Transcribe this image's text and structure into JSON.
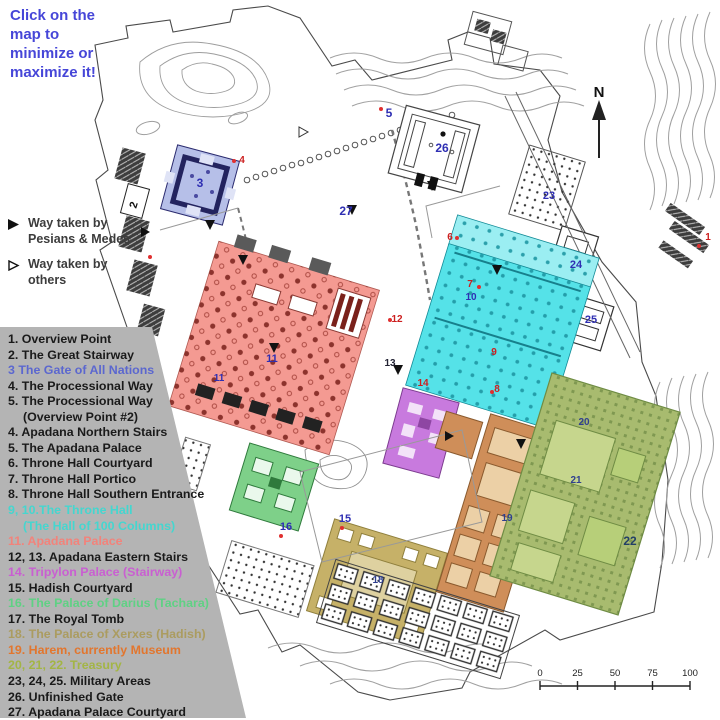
{
  "instruction": {
    "line1": "Click on the",
    "line2": "map to",
    "line3": "minimize or",
    "line4": "maximize it!"
  },
  "way_legend": [
    {
      "marker": "filled-arrow",
      "line1": "Way taken by",
      "line2": "Pesians & Medes"
    },
    {
      "marker": "open-arrow",
      "line1": "Way taken by",
      "line2": "others"
    }
  ],
  "legend": {
    "items": [
      {
        "text": "1. Overview Point",
        "color": "#1a1a1a"
      },
      {
        "text": "2. The Great Stairway",
        "color": "#1a1a1a"
      },
      {
        "text": "3 The Gate of All Nations",
        "color": "#5b67cf"
      },
      {
        "text": "4. The Processional Way",
        "color": "#1a1a1a"
      },
      {
        "text": "5. The Processional Way",
        "color": "#1a1a1a"
      },
      {
        "text": "(Overview Point #2)",
        "color": "#1a1a1a",
        "indent": true
      },
      {
        "text": "4. Apadana Northern Stairs",
        "color": "#1a1a1a"
      },
      {
        "text": "5. The Apadana Palace",
        "color": "#1a1a1a"
      },
      {
        "text": "6. Throne Hall Courtyard",
        "color": "#1a1a1a"
      },
      {
        "text": "7. Throne Hall Portico",
        "color": "#1a1a1a"
      },
      {
        "text": "8. Throne Hall Southern Entrance",
        "color": "#1a1a1a"
      },
      {
        "text": "9, 10.The Throne Hall",
        "color": "#45d6cf"
      },
      {
        "text": "(The Hall of 100 Columns)",
        "color": "#45d6cf",
        "indent": true
      },
      {
        "text": "11. Apadana Palace",
        "color": "#f2837b"
      },
      {
        "text": "12, 13. Apadana Eastern Stairs",
        "color": "#1a1a1a"
      },
      {
        "text": "14. Tripylon Palace (Stairway)",
        "color": "#c95fd1"
      },
      {
        "text": "15. Hadish Courtyard",
        "color": "#1a1a1a"
      },
      {
        "text": "16. The Palace of Darius (Tachara)",
        "color": "#5fd184"
      },
      {
        "text": "17. The Royal Tomb",
        "color": "#1a1a1a"
      },
      {
        "text": "18. The Palace of Xerxes (Hadish)",
        "color": "#ab9c60"
      },
      {
        "text": "19. Harem, currently Museum",
        "color": "#e2762e"
      },
      {
        "text": "20, 21, 22. Treasury",
        "color": "#a3b545"
      },
      {
        "text": "23, 24, 25. Military Areas",
        "color": "#1a1a1a"
      },
      {
        "text": "26. Unfinished Gate",
        "color": "#1a1a1a"
      },
      {
        "text": "27. Apadana Palace Courtyard",
        "color": "#1a1a1a"
      }
    ]
  },
  "map": {
    "north_label": "N",
    "regions": [
      {
        "name": "gate-of-all-nations",
        "color": "#b6bfe8"
      },
      {
        "name": "apadana-palace",
        "color": "#f49a92"
      },
      {
        "name": "throne-hall",
        "color": "#55e2e8"
      },
      {
        "name": "throne-hall-portico",
        "color": "#9beef2"
      },
      {
        "name": "tripylon-palace",
        "color": "#c87ade"
      },
      {
        "name": "palace-of-darius-tachara",
        "color": "#7ed089"
      },
      {
        "name": "palace-of-xerxes-hadish",
        "color": "#c6b168"
      },
      {
        "name": "harem-museum",
        "color": "#cf8e59"
      },
      {
        "name": "treasury",
        "color": "#a8bb6f"
      }
    ],
    "labels": [
      {
        "text": "N",
        "x": 599,
        "y": 97,
        "color": "#111111",
        "size": 15
      },
      {
        "text": "1",
        "x": 708,
        "y": 240,
        "color": "#cc2020",
        "size": 10
      },
      {
        "text": "2",
        "x": 137,
        "y": 206,
        "color": "#111111",
        "size": 11,
        "rotate": -73
      },
      {
        "text": "3",
        "x": 200,
        "y": 187,
        "color": "#2f2fb3",
        "size": 12
      },
      {
        "text": "4",
        "x": 242,
        "y": 163,
        "color": "#cc2020",
        "size": 10
      },
      {
        "text": "5",
        "x": 389,
        "y": 117,
        "color": "#2f2fb3",
        "size": 12
      },
      {
        "text": "6",
        "x": 450,
        "y": 240,
        "color": "#cc2020",
        "size": 10
      },
      {
        "text": "7",
        "x": 470,
        "y": 287,
        "color": "#cc2020",
        "size": 10
      },
      {
        "text": "10",
        "x": 471,
        "y": 300,
        "color": "#2f2fb3",
        "size": 10
      },
      {
        "text": "9",
        "x": 494,
        "y": 355,
        "color": "#cc2020",
        "size": 10
      },
      {
        "text": "8",
        "x": 497,
        "y": 392,
        "color": "#cc2020",
        "size": 10
      },
      {
        "text": "11",
        "x": 272,
        "y": 362,
        "color": "#2f2fb3",
        "size": 11
      },
      {
        "text": "11",
        "x": 219,
        "y": 381,
        "color": "#2f2fb3",
        "size": 10
      },
      {
        "text": "12",
        "x": 397,
        "y": 322,
        "color": "#cc2020",
        "size": 10
      },
      {
        "text": "13",
        "x": 390,
        "y": 366,
        "color": "#222233",
        "size": 10
      },
      {
        "text": "14",
        "x": 423,
        "y": 386,
        "color": "#cc2020",
        "size": 10
      },
      {
        "text": "15",
        "x": 345,
        "y": 522,
        "color": "#2f2fb3",
        "size": 11
      },
      {
        "text": "16",
        "x": 286,
        "y": 530,
        "color": "#2f2fb3",
        "size": 11
      },
      {
        "text": "18",
        "x": 378,
        "y": 583,
        "color": "#2f3f8f",
        "size": 10
      },
      {
        "text": "19",
        "x": 507,
        "y": 521,
        "color": "#2f3f8f",
        "size": 10
      },
      {
        "text": "20",
        "x": 584,
        "y": 425,
        "color": "#2f3f8f",
        "size": 10
      },
      {
        "text": "21",
        "x": 576,
        "y": 483,
        "color": "#2f3f8f",
        "size": 10
      },
      {
        "text": "22",
        "x": 630,
        "y": 545,
        "color": "#223f66",
        "size": 12
      },
      {
        "text": "23",
        "x": 549,
        "y": 199,
        "color": "#2f2fb3",
        "size": 11
      },
      {
        "text": "24",
        "x": 576,
        "y": 268,
        "color": "#2f2fb3",
        "size": 11
      },
      {
        "text": "25",
        "x": 591,
        "y": 323,
        "color": "#2f2fb3",
        "size": 11
      },
      {
        "text": "26",
        "x": 442,
        "y": 152,
        "color": "#2f2fb3",
        "size": 12
      },
      {
        "text": "27",
        "x": 346,
        "y": 215,
        "color": "#2f2fb3",
        "size": 12
      }
    ],
    "scale": {
      "ticks": [
        "0",
        "25",
        "50",
        "75",
        "100"
      ]
    }
  }
}
